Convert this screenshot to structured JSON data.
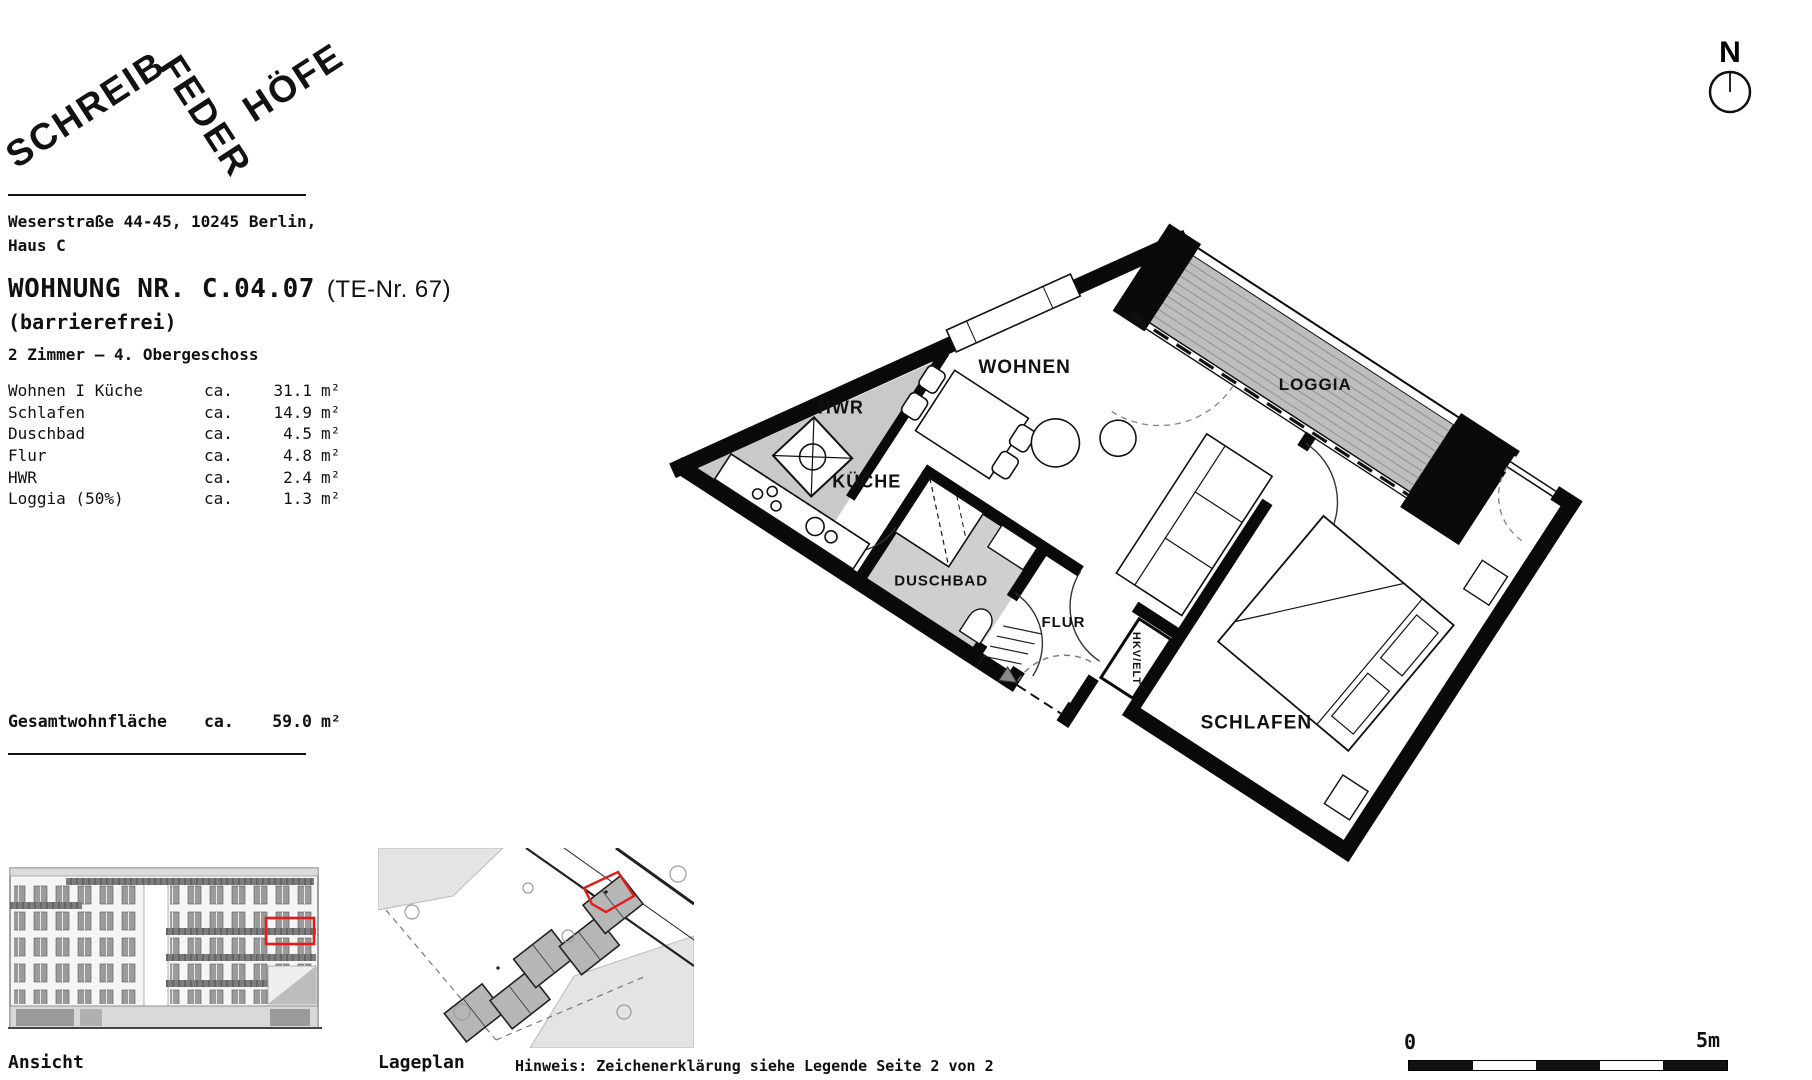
{
  "logo": {
    "word1": "SCHREIB",
    "word2": "FEDER",
    "word3": "HÖFE"
  },
  "header": {
    "address_line1": "Weserstraße 44-45, 10245 Berlin,",
    "address_line2": "Haus C",
    "title": "WOHNUNG NR. C.04.07",
    "title_suffix": "(TE-Nr. 67)",
    "subtitle": "(barrierefrei)",
    "floor_info": "2 Zimmer — 4. Obergeschoss"
  },
  "area_table": {
    "ca": "ca.",
    "unit": "m²",
    "rooms": [
      {
        "name": "Wohnen I Küche",
        "value": "31.1"
      },
      {
        "name": "Schlafen",
        "value": "14.9"
      },
      {
        "name": "Duschbad",
        "value": "4.5"
      },
      {
        "name": "Flur",
        "value": "4.8"
      },
      {
        "name": "HWR",
        "value": "2.4"
      },
      {
        "name": "Loggia (50%)",
        "value": "1.3"
      }
    ],
    "total": {
      "label": "Gesamtwohnfläche",
      "value": "59.0"
    }
  },
  "plan": {
    "labels": {
      "hwr": "HWR",
      "kueche": "KÜCHE",
      "wohnen": "WOHNEN",
      "loggia": "LOGGIA",
      "schlafen": "SCHLAFEN",
      "duschbad": "DUSCHBAD",
      "flur": "FLUR",
      "hkv": "HKV/ELT"
    },
    "north_label": "N"
  },
  "scalebar": {
    "start": "0",
    "end": "5m"
  },
  "footer": {
    "ansicht": "Ansicht",
    "lageplan": "Lageplan",
    "hinweis": "Hinweis: Zeichenerklärung siehe Legende Seite 2 von 2"
  }
}
